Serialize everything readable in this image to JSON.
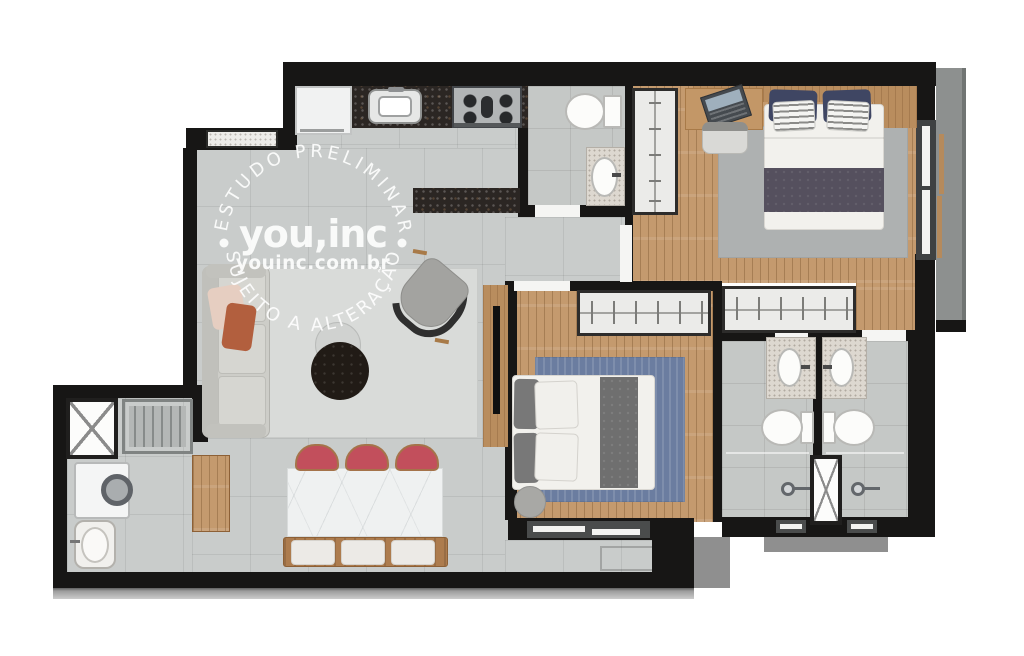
{
  "watermark": {
    "arc_top_text": "ESTUDO PRELIMINAR",
    "arc_bottom_text": "SUJEITO A ALTERAÇÃO",
    "brand_text": "you,inc",
    "website_text": "youinc.com.br",
    "text_color": "#ffffff"
  },
  "palette": {
    "background": "#ffffff",
    "wall": "#171615",
    "tile_floor": "#c9cccb",
    "bathroom_tile": "#c5c8c6",
    "wood_floor": "#c49a6e",
    "dark_granite_counter": "#2b2623",
    "light_granite_vanity": "#ddd8d0",
    "marble_table": "#eff1f1",
    "living_rug": "#d9dbd9",
    "bedroom1_rug": "#aeb1b1",
    "bedroom2_rug": "#6b7da0",
    "dining_chair_red": "#c24f5c",
    "pillow_navy": "#3f4663",
    "bed_runner_dark": "#55505e",
    "balcony_gray": "#8d908f"
  },
  "plan": {
    "type": "apartment-floor-plan",
    "fixtures": [
      "refrigerator",
      "kitchen-sink",
      "cooktop-4-burners",
      "kitchen-counter",
      "bar-counter",
      "toilet",
      "vanity-sink",
      "shower-head",
      "double-bed",
      "wardrobe",
      "closet-dresser",
      "desk-with-laptop",
      "desk-chair",
      "sofa",
      "armchair",
      "coffee-tables",
      "tv-panel",
      "dining-table",
      "dining-chairs",
      "dining-bench",
      "sideboard",
      "washing-machine",
      "laundry-sink",
      "drying-rack",
      "ventilation-shaft",
      "window",
      "door-opening",
      "pouf",
      "rug"
    ]
  }
}
